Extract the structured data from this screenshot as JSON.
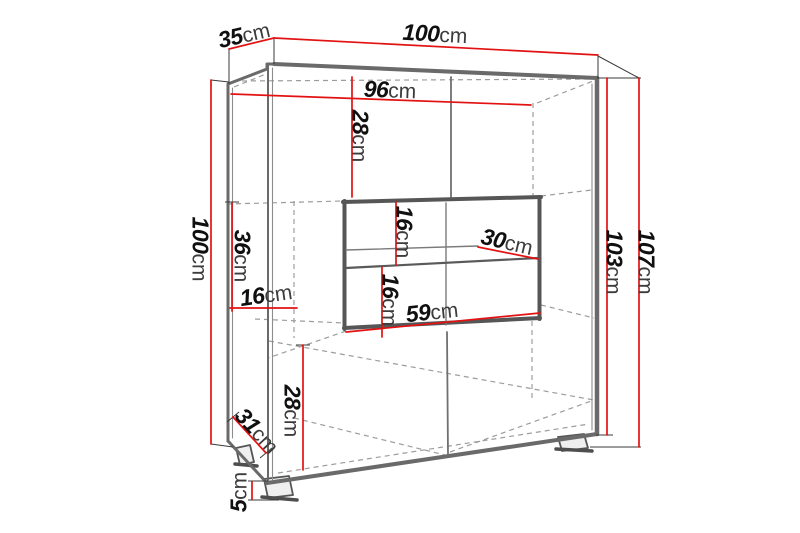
{
  "diagram": {
    "kind": "furniture-dimension-drawing",
    "unit": "cm",
    "colors": {
      "dimension_line": "#e31212",
      "outline": "#6a6a6a",
      "hidden_line": "#9c9c9c",
      "extension_line": "#3a3a3a",
      "number_text": "#101010",
      "unit_text": "#3c3c3c",
      "background": "#ffffff"
    },
    "dimensions": [
      {
        "id": "top-depth",
        "value": "35",
        "unit": "cm",
        "x": 244,
        "y": 35,
        "rotate": -13
      },
      {
        "id": "top-width",
        "value": "100",
        "unit": "cm",
        "x": 435,
        "y": 34,
        "rotate": 3
      },
      {
        "id": "inner-width",
        "value": "96",
        "unit": "cm",
        "x": 390,
        "y": 90,
        "rotate": 2
      },
      {
        "id": "upper-section-height",
        "value": "28",
        "unit": "cm",
        "x": 360,
        "y": 136,
        "rotate": 90
      },
      {
        "id": "left-height",
        "value": "100",
        "unit": "cm",
        "x": 200,
        "y": 249,
        "rotate": 90
      },
      {
        "id": "niche-outer-height",
        "value": "36",
        "unit": "cm",
        "x": 242,
        "y": 256,
        "rotate": 90
      },
      {
        "id": "left-inset-depth",
        "value": "16",
        "unit": "cm",
        "x": 266,
        "y": 295,
        "rotate": -8
      },
      {
        "id": "niche-upper-height",
        "value": "16",
        "unit": "cm",
        "x": 404,
        "y": 232,
        "rotate": 90
      },
      {
        "id": "niche-lower-height",
        "value": "16",
        "unit": "cm",
        "x": 390,
        "y": 300,
        "rotate": 90
      },
      {
        "id": "shelf-depth",
        "value": "30",
        "unit": "cm",
        "x": 507,
        "y": 242,
        "rotate": 13
      },
      {
        "id": "niche-width",
        "value": "59",
        "unit": "cm",
        "x": 432,
        "y": 312,
        "rotate": -6
      },
      {
        "id": "body-height",
        "value": "103",
        "unit": "cm",
        "x": 614,
        "y": 262,
        "rotate": 90
      },
      {
        "id": "total-height",
        "value": "107",
        "unit": "cm",
        "x": 646,
        "y": 262,
        "rotate": 90
      },
      {
        "id": "lower-section-height",
        "value": "28",
        "unit": "cm",
        "x": 292,
        "y": 411,
        "rotate": 90
      },
      {
        "id": "bottom-depth",
        "value": "31",
        "unit": "cm",
        "x": 257,
        "y": 431,
        "rotate": 47
      },
      {
        "id": "foot-height",
        "value": "5",
        "unit": "cm",
        "x": 239,
        "y": 492,
        "rotate": -90
      }
    ]
  }
}
